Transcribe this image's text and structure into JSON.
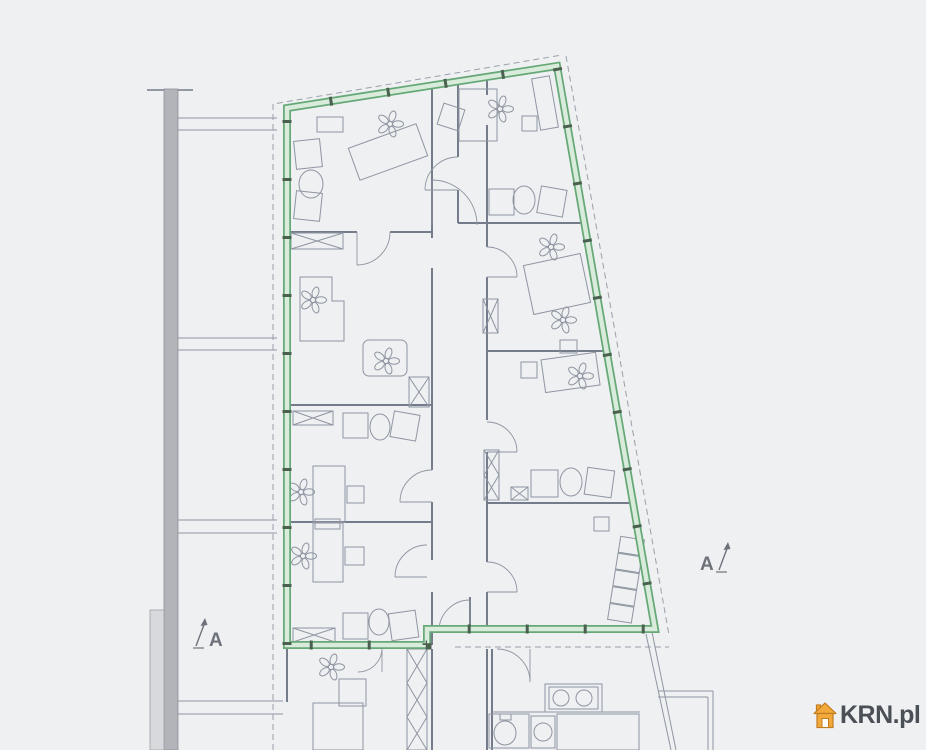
{
  "colors": {
    "bg": "#eef0f2",
    "plan_line": "#8f95a1",
    "plan_line_dark": "#747b8a",
    "wall_fill": "#b2b4ba",
    "wall_fill_light": "#d8d9dc",
    "dashed_line": "#9aa0ab",
    "unit_green": "#66a877",
    "unit_green_light": "#d9ebdb",
    "boundary_node": "#4a614f",
    "marker_gray": "#6e737b",
    "watermark_text": "#4b5057",
    "watermark_orange": "#f2a93c",
    "watermark_orange_dark": "#c27c1e"
  },
  "section_markers": {
    "left": {
      "label": "A"
    },
    "right": {
      "label": "A"
    }
  },
  "watermark": {
    "icon": "house-icon",
    "text": "KRN.pl"
  }
}
